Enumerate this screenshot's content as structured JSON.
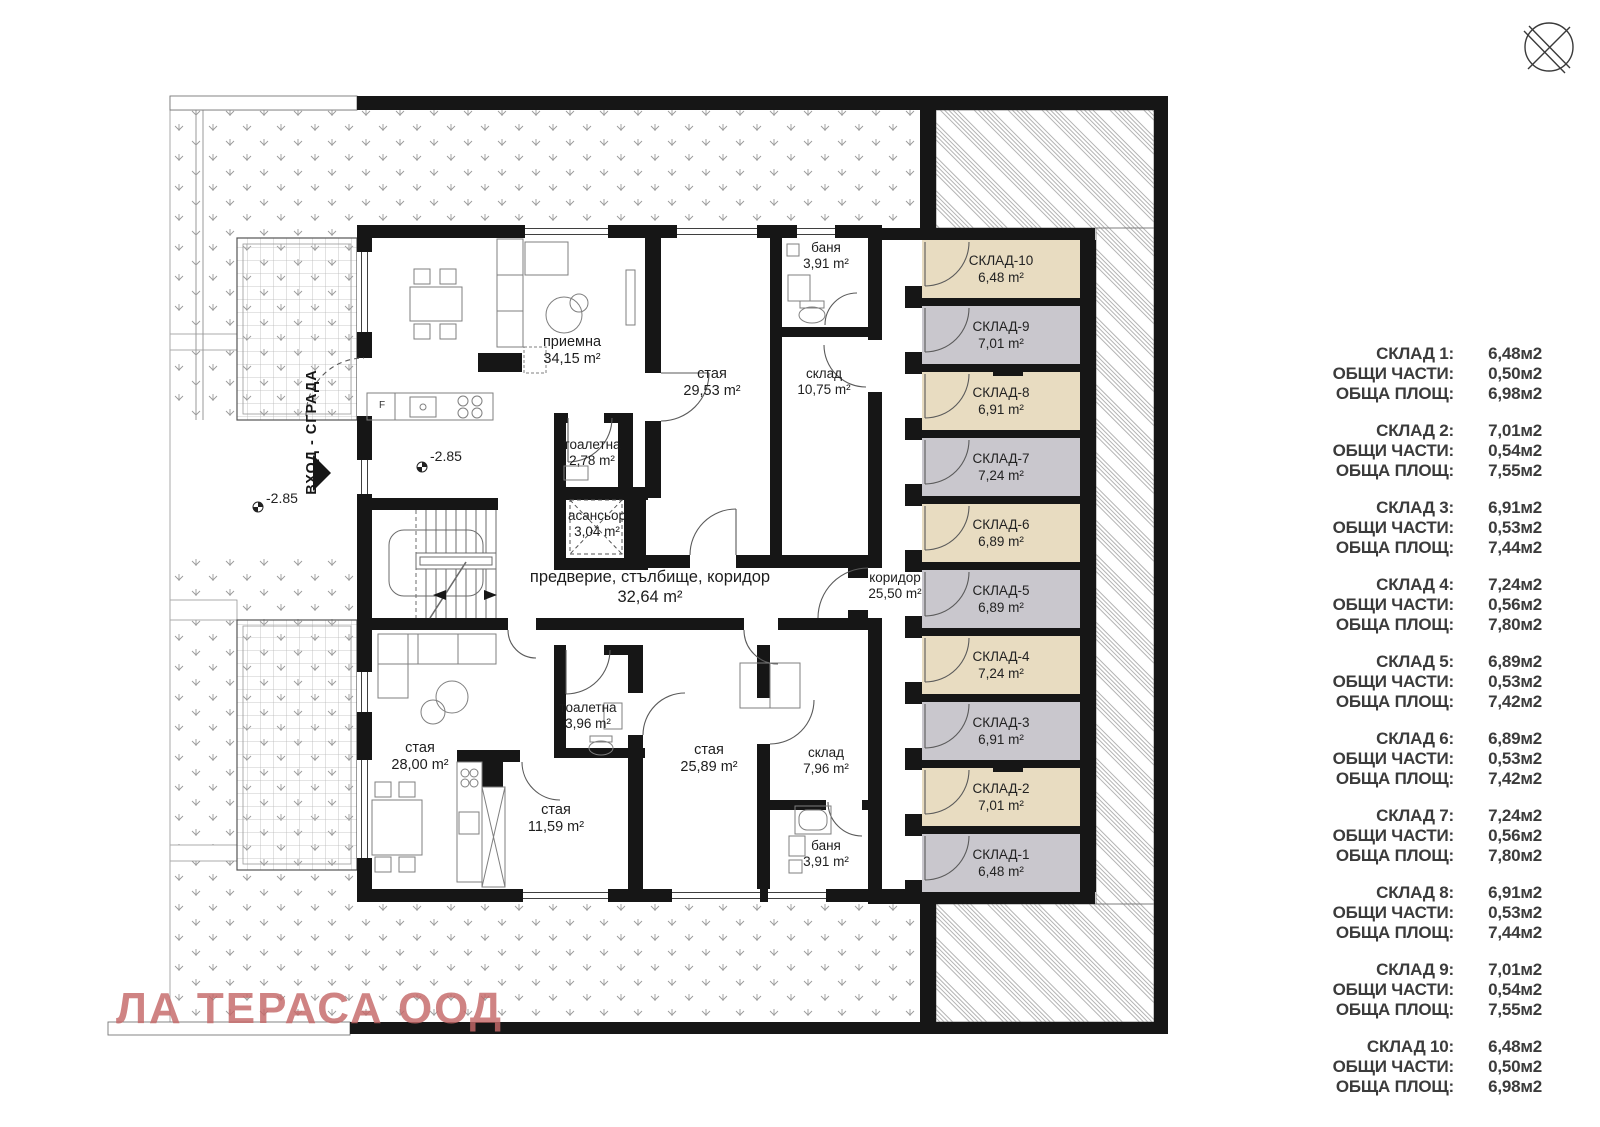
{
  "colors": {
    "wall": "#161616",
    "storage_tan": "#e8dcc1",
    "storage_gray": "#c9c7cd",
    "watermark": "#c56868"
  },
  "plan": {
    "rooms": [
      {
        "name": "приемна",
        "area": "34,15 m²"
      },
      {
        "name": "стая",
        "area": "29,53 m²"
      },
      {
        "name": "склад",
        "area": "10,75 m²"
      },
      {
        "name": "баня",
        "area": "3,91 m²"
      },
      {
        "name": "тоалетна",
        "area": "2,78 m²"
      },
      {
        "name": "асансьор",
        "area": "3,04 m²"
      },
      {
        "name": "предверие, стълбище, коридор",
        "area": "32,64 m²"
      },
      {
        "name": "коридор",
        "area": "25,50 m²"
      },
      {
        "name": "стая",
        "area": "28,00 m²"
      },
      {
        "name": "тоалетна",
        "area": "3,96 m²"
      },
      {
        "name": "стая",
        "area": "25,89 m²"
      },
      {
        "name": "склад",
        "area": "7,96 m²"
      },
      {
        "name": "стая",
        "area": "11,59 m²"
      },
      {
        "name": "баня",
        "area": "3,91 m²"
      }
    ],
    "storage_units": [
      {
        "name": "СКЛАД-10",
        "area": "6,48 m²"
      },
      {
        "name": "СКЛАД-9",
        "area": "7,01 m²"
      },
      {
        "name": "СКЛАД-8",
        "area": "6,91 m²"
      },
      {
        "name": "СКЛАД-7",
        "area": "7,24 m²"
      },
      {
        "name": "СКЛАД-6",
        "area": "6,89 m²"
      },
      {
        "name": "СКЛАД-5",
        "area": "6,89 m²"
      },
      {
        "name": "СКЛАД-4",
        "area": "7,24 m²"
      },
      {
        "name": "СКЛАД-3",
        "area": "6,91 m²"
      },
      {
        "name": "СКЛАД-2",
        "area": "7,01 m²"
      },
      {
        "name": "СКЛАД-1",
        "area": "6,48 m²"
      }
    ],
    "annotations": {
      "entrance": "ВХОД - СГРАДА",
      "level_a": "-2.85",
      "level_b": "-2.85",
      "fridge": "F"
    }
  },
  "legend": {
    "groups": [
      {
        "rows": [
          {
            "label": "СКЛАД 1:",
            "value": "6,48м2"
          },
          {
            "label": "ОБЩИ ЧАСТИ:",
            "value": "0,50м2"
          },
          {
            "label": "ОБЩА ПЛОЩ:",
            "value": "6,98м2"
          }
        ]
      },
      {
        "rows": [
          {
            "label": "СКЛАД 2:",
            "value": "7,01м2"
          },
          {
            "label": "ОБЩИ ЧАСТИ:",
            "value": "0,54м2"
          },
          {
            "label": "ОБЩА ПЛОЩ:",
            "value": "7,55м2"
          }
        ]
      },
      {
        "rows": [
          {
            "label": "СКЛАД 3:",
            "value": "6,91м2"
          },
          {
            "label": "ОБЩИ ЧАСТИ:",
            "value": "0,53м2"
          },
          {
            "label": "ОБЩА ПЛОЩ:",
            "value": "7,44м2"
          }
        ]
      },
      {
        "rows": [
          {
            "label": "СКЛАД 4:",
            "value": "7,24м2"
          },
          {
            "label": "ОБЩИ ЧАСТИ:",
            "value": "0,56м2"
          },
          {
            "label": "ОБЩА ПЛОЩ:",
            "value": "7,80м2"
          }
        ]
      },
      {
        "rows": [
          {
            "label": "СКЛАД 5:",
            "value": "6,89м2"
          },
          {
            "label": "ОБЩИ ЧАСТИ:",
            "value": "0,53м2"
          },
          {
            "label": "ОБЩА ПЛОЩ:",
            "value": "7,42м2"
          }
        ]
      },
      {
        "rows": [
          {
            "label": "СКЛАД 6:",
            "value": "6,89м2"
          },
          {
            "label": "ОБЩИ ЧАСТИ:",
            "value": "0,53м2"
          },
          {
            "label": "ОБЩА ПЛОЩ:",
            "value": "7,42м2"
          }
        ]
      },
      {
        "rows": [
          {
            "label": "СКЛАД 7:",
            "value": "7,24м2"
          },
          {
            "label": "ОБЩИ ЧАСТИ:",
            "value": "0,56м2"
          },
          {
            "label": "ОБЩА ПЛОЩ:",
            "value": "7,80м2"
          }
        ]
      },
      {
        "rows": [
          {
            "label": "СКЛАД 8:",
            "value": "6,91м2"
          },
          {
            "label": "ОБЩИ ЧАСТИ:",
            "value": "0,53м2"
          },
          {
            "label": "ОБЩА ПЛОЩ:",
            "value": "7,44м2"
          }
        ]
      },
      {
        "rows": [
          {
            "label": "СКЛАД 9:",
            "value": "7,01м2"
          },
          {
            "label": "ОБЩИ ЧАСТИ:",
            "value": "0,54м2"
          },
          {
            "label": "ОБЩА ПЛОЩ:",
            "value": "7,55м2"
          }
        ]
      },
      {
        "rows": [
          {
            "label": "СКЛАД 10:",
            "value": "6,48м2"
          },
          {
            "label": "ОБЩИ ЧАСТИ:",
            "value": "0,50м2"
          },
          {
            "label": "ОБЩА ПЛОЩ:",
            "value": "6,98м2"
          }
        ]
      }
    ]
  },
  "watermark": {
    "text": "ЛА ТЕРАСА ООД"
  }
}
